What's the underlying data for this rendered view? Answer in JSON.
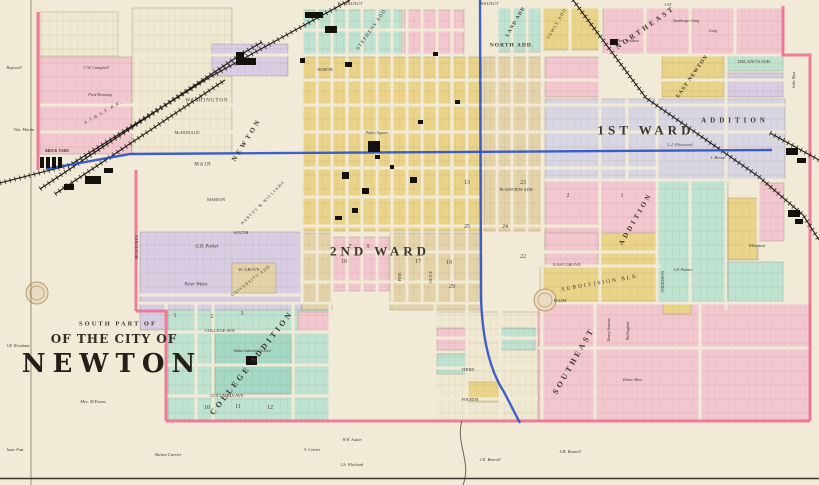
{
  "map": {
    "title": {
      "line1": "SOUTH PART OF",
      "line2": "OF THE CITY OF",
      "line3": "NEWTON"
    },
    "palette": {
      "paper": "#f1ead7",
      "cream": "#efe8d0",
      "pink": "#f3c7cf",
      "pinkline": "#ee6a8e",
      "yellow": "#e9d48a",
      "tan": "#e4d3a8",
      "teal": "#bfe2d1",
      "teal2": "#a5d8c5",
      "lav": "#d9cde3",
      "lavgrey": "#d9d6e4",
      "blue": "#2b50c8",
      "ink": "#14100c"
    },
    "regions": [
      [
        40,
        12,
        78,
        44,
        "cream"
      ],
      [
        40,
        57,
        92,
        97,
        "pink"
      ],
      [
        132,
        8,
        100,
        146,
        "cream"
      ],
      [
        212,
        44,
        76,
        32,
        "lav"
      ],
      [
        302,
        10,
        100,
        45,
        "teal"
      ],
      [
        404,
        10,
        60,
        45,
        "pink"
      ],
      [
        497,
        8,
        44,
        44,
        "teal"
      ],
      [
        543,
        8,
        58,
        42,
        "yellow"
      ],
      [
        603,
        8,
        180,
        46,
        "pink"
      ],
      [
        302,
        57,
        180,
        174,
        "yellow"
      ],
      [
        484,
        57,
        58,
        174,
        "tan"
      ],
      [
        545,
        57,
        55,
        40,
        "pink"
      ],
      [
        545,
        99,
        240,
        80,
        "lavgrey"
      ],
      [
        662,
        55,
        62,
        42,
        "yellow"
      ],
      [
        726,
        55,
        57,
        16,
        "teal"
      ],
      [
        726,
        73,
        57,
        24,
        "lav"
      ],
      [
        545,
        181,
        112,
        70,
        "pink"
      ],
      [
        658,
        181,
        70,
        122,
        "teal"
      ],
      [
        728,
        198,
        30,
        62,
        "yellow"
      ],
      [
        758,
        183,
        26,
        58,
        "pink"
      ],
      [
        728,
        262,
        55,
        48,
        "teal"
      ],
      [
        600,
        233,
        57,
        32,
        "yellow"
      ],
      [
        545,
        233,
        53,
        32,
        "pink"
      ],
      [
        540,
        267,
        118,
        34,
        "yellow"
      ],
      [
        538,
        303,
        272,
        117,
        "pink"
      ],
      [
        140,
        232,
        162,
        62,
        "lav"
      ],
      [
        140,
        296,
        162,
        34,
        "lav"
      ],
      [
        232,
        263,
        44,
        30,
        "tan"
      ],
      [
        333,
        237,
        56,
        54,
        "pink"
      ],
      [
        302,
        233,
        30,
        77,
        "tan"
      ],
      [
        390,
        233,
        92,
        77,
        "tan"
      ],
      [
        168,
        310,
        162,
        110,
        "teal"
      ],
      [
        215,
        332,
        76,
        62,
        "teal2"
      ],
      [
        298,
        312,
        32,
        20,
        "pink"
      ],
      [
        435,
        312,
        103,
        108,
        "cream"
      ],
      [
        437,
        328,
        30,
        22,
        "pink"
      ],
      [
        437,
        354,
        30,
        20,
        "teal"
      ],
      [
        467,
        382,
        32,
        20,
        "yellow"
      ],
      [
        500,
        328,
        35,
        22,
        "teal"
      ],
      [
        663,
        303,
        28,
        11,
        "yellow"
      ]
    ],
    "streets_h": [
      [
        7,
        300,
        785
      ],
      [
        30,
        302,
        464
      ],
      [
        55,
        137,
        785
      ],
      [
        80,
        302,
        785
      ],
      [
        105,
        40,
        785
      ],
      [
        132,
        40,
        785
      ],
      [
        168,
        137,
        657
      ],
      [
        180,
        545,
        785
      ],
      [
        197,
        137,
        482
      ],
      [
        226,
        137,
        600
      ],
      [
        252,
        302,
        657
      ],
      [
        266,
        545,
        660
      ],
      [
        282,
        302,
        482
      ],
      [
        295,
        140,
        302
      ],
      [
        303,
        137,
        810
      ],
      [
        332,
        166,
        330
      ],
      [
        338,
        430,
        538
      ],
      [
        348,
        538,
        810
      ],
      [
        365,
        166,
        330
      ],
      [
        368,
        430,
        538
      ],
      [
        396,
        166,
        330
      ],
      [
        399,
        430,
        538
      ]
    ],
    "streets_v": [
      [
        137,
        55,
        330
      ],
      [
        166,
        303,
        421
      ],
      [
        196,
        303,
        421
      ],
      [
        213,
        303,
        421
      ],
      [
        293,
        303,
        421
      ],
      [
        330,
        303,
        421
      ],
      [
        302,
        7,
        303
      ],
      [
        317,
        7,
        303
      ],
      [
        332,
        7,
        303
      ],
      [
        347,
        7,
        303
      ],
      [
        362,
        7,
        303
      ],
      [
        377,
        7,
        303
      ],
      [
        392,
        7,
        303
      ],
      [
        407,
        7,
        303
      ],
      [
        422,
        7,
        303
      ],
      [
        437,
        7,
        303
      ],
      [
        452,
        7,
        303
      ],
      [
        467,
        7,
        303
      ],
      [
        497,
        7,
        303
      ],
      [
        512,
        7,
        303
      ],
      [
        527,
        7,
        303
      ],
      [
        542,
        7,
        421
      ],
      [
        570,
        7,
        55
      ],
      [
        600,
        7,
        303
      ],
      [
        627,
        99,
        180
      ],
      [
        645,
        7,
        55
      ],
      [
        657,
        55,
        303
      ],
      [
        690,
        7,
        55
      ],
      [
        690,
        181,
        303
      ],
      [
        726,
        55,
        310
      ],
      [
        735,
        7,
        55
      ],
      [
        758,
        181,
        245
      ],
      [
        595,
        303,
        421
      ],
      [
        700,
        303,
        421
      ],
      [
        435,
        303,
        421
      ],
      [
        467,
        303,
        421
      ],
      [
        500,
        303,
        421
      ]
    ],
    "boundary": [
      "M38,12 L38,170",
      "M136,170 L136,311",
      "M136,311 L166,311 L166,421",
      "M166,421 L810,421",
      "M810,421 L810,55 L783,55 L783,6"
    ],
    "railroads": [
      "M0,183 L70,165 L210,77 L350,0",
      "M40,189 L240,55 L262,42",
      "M55,194 L225,80",
      "M573,0 L646,98 L758,176 L803,215 L819,240",
      "M770,133 L819,160"
    ],
    "water_blue": [
      "M46,169 L130,154 L772,150",
      "M480,0 L481,298 Q483,360 504,392 L520,423"
    ],
    "water_creek": [
      "M462,421 C455,442 472,462 463,485"
    ],
    "buildings": [
      [
        236,
        58,
        20,
        7
      ],
      [
        236,
        52,
        8,
        13
      ],
      [
        305,
        12,
        18,
        6
      ],
      [
        325,
        26,
        12,
        7
      ],
      [
        85,
        176,
        16,
        8
      ],
      [
        104,
        168,
        9,
        5
      ],
      [
        64,
        184,
        10,
        6
      ],
      [
        40,
        157,
        4,
        11
      ],
      [
        46,
        157,
        4,
        11
      ],
      [
        52,
        157,
        4,
        11
      ],
      [
        58,
        157,
        4,
        11
      ],
      [
        368,
        141,
        12,
        11
      ],
      [
        342,
        172,
        7,
        7
      ],
      [
        362,
        188,
        7,
        6
      ],
      [
        410,
        177,
        7,
        6
      ],
      [
        345,
        62,
        7,
        5
      ],
      [
        300,
        58,
        5,
        5
      ],
      [
        433,
        52,
        5,
        4
      ],
      [
        455,
        100,
        5,
        4
      ],
      [
        418,
        120,
        5,
        4
      ],
      [
        375,
        155,
        5,
        4
      ],
      [
        390,
        165,
        4,
        4
      ],
      [
        352,
        208,
        6,
        5
      ],
      [
        335,
        216,
        7,
        4
      ],
      [
        610,
        39,
        8,
        6
      ],
      [
        246,
        356,
        11,
        9
      ],
      [
        786,
        148,
        12,
        7
      ],
      [
        797,
        158,
        9,
        5
      ],
      [
        788,
        210,
        12,
        7
      ],
      [
        795,
        219,
        8,
        5
      ]
    ],
    "seals": [
      [
        37,
        293
      ],
      [
        545,
        300
      ]
    ],
    "labels": [
      {
        "t": "1ST WARD",
        "x": 646,
        "y": 130,
        "s": 13,
        "r": 0,
        "ls": 4,
        "b": 1
      },
      {
        "t": "2ND WARD",
        "x": 380,
        "y": 251,
        "s": 13,
        "r": 0,
        "ls": 4,
        "b": 1
      },
      {
        "t": "NORTHEAST",
        "x": 646,
        "y": 28,
        "s": 7,
        "r": -35,
        "ls": 3,
        "b": 1
      },
      {
        "t": "NORTH ADD.",
        "x": 512,
        "y": 46,
        "s": 5.5,
        "r": 0,
        "ls": 1,
        "b": 1
      },
      {
        "t": "LAND ADD",
        "x": 516,
        "y": 22,
        "s": 5,
        "r": -60,
        "ls": 1,
        "b": 1
      },
      {
        "t": "TOWLE ADD",
        "x": 557,
        "y": 24,
        "s": 4.5,
        "r": -60,
        "ls": 1
      },
      {
        "t": "EAST NEWTON",
        "x": 693,
        "y": 77,
        "s": 5.5,
        "r": -55,
        "ls": 1,
        "b": 1
      },
      {
        "t": "DELANO'S SUB",
        "x": 754,
        "y": 62,
        "s": 4.5,
        "r": 0,
        "ls": 0
      },
      {
        "t": "STEPHENS ADD",
        "x": 372,
        "y": 30,
        "s": 5,
        "r": -55,
        "ls": 1
      },
      {
        "t": "NEWTON",
        "x": 247,
        "y": 140,
        "s": 7,
        "r": -58,
        "ls": 3,
        "b": 1
      },
      {
        "t": "ADDITION",
        "x": 636,
        "y": 219,
        "s": 7,
        "r": -60,
        "ls": 3,
        "b": 1
      },
      {
        "t": "ADDITION",
        "x": 735,
        "y": 121,
        "s": 7,
        "r": 0,
        "ls": 4,
        "b": 1
      },
      {
        "t": "PLAINVIEW ADD",
        "x": 516,
        "y": 190,
        "s": 4.2,
        "r": 0,
        "ls": 0
      },
      {
        "t": "COLLEGE ADDITION",
        "x": 252,
        "y": 363,
        "s": 8,
        "r": -52,
        "ls": 3,
        "b": 1
      },
      {
        "t": "SOUTHEAST",
        "x": 574,
        "y": 361,
        "s": 8,
        "r": -60,
        "ls": 3,
        "b": 1
      },
      {
        "t": "SUBDIVISION BLK",
        "x": 600,
        "y": 284,
        "s": 5.5,
        "r": -10,
        "ls": 2
      },
      {
        "t": "HARVEY & WILLIAMS",
        "x": 263,
        "y": 203,
        "s": 4.2,
        "r": -45,
        "ls": 1
      },
      {
        "t": "UNIVERSITY ADD",
        "x": 251,
        "y": 281,
        "s": 4.2,
        "r": -38,
        "ls": 1
      },
      {
        "t": "A.T.& S.F. R.R.",
        "x": 103,
        "y": 113,
        "s": 4.5,
        "r": -30,
        "ls": 1,
        "i": 1
      },
      {
        "t": "W. WALNUT",
        "x": 350,
        "y": 4,
        "s": 4.5,
        "r": 0
      },
      {
        "t": "WALNUT",
        "x": 489,
        "y": 4,
        "s": 4.5,
        "r": 0
      },
      {
        "t": "NORTH",
        "x": 325,
        "y": 70,
        "s": 4.5,
        "r": 0
      },
      {
        "t": "WASHINGTON",
        "x": 207,
        "y": 101,
        "s": 5,
        "r": 0,
        "ls": 1
      },
      {
        "t": "McDONALD",
        "x": 187,
        "y": 133,
        "s": 4.5,
        "r": 0
      },
      {
        "t": "MAIN",
        "x": 203,
        "y": 165,
        "s": 5,
        "r": 0,
        "ls": 1
      },
      {
        "t": "MARION",
        "x": 216,
        "y": 200,
        "s": 4.5,
        "r": 0
      },
      {
        "t": "SOUTH",
        "x": 241,
        "y": 233,
        "s": 4.5,
        "r": 0
      },
      {
        "t": "W. GROVE",
        "x": 249,
        "y": 270,
        "s": 4.5,
        "r": 0
      },
      {
        "t": "EAST GROVE",
        "x": 567,
        "y": 265,
        "s": 4.5,
        "r": 0
      },
      {
        "t": "PLUM",
        "x": 560,
        "y": 301,
        "s": 4.5,
        "r": 0
      },
      {
        "t": "COLLEGE AVE",
        "x": 220,
        "y": 331,
        "s": 4.5,
        "r": 0
      },
      {
        "t": "COLUMBIA AVE",
        "x": 227,
        "y": 396,
        "s": 4.5,
        "r": 0
      },
      {
        "t": "MONTEREY",
        "x": 137,
        "y": 247,
        "s": 4.5,
        "r": -90
      },
      {
        "t": "PINE",
        "x": 400,
        "y": 277,
        "s": 4,
        "r": -90
      },
      {
        "t": "OLIVE",
        "x": 431,
        "y": 277,
        "s": 4,
        "r": -90
      },
      {
        "t": "ANDERSON",
        "x": 663,
        "y": 282,
        "s": 4,
        "r": -90
      },
      {
        "t": "THIRD",
        "x": 468,
        "y": 370,
        "s": 4.2,
        "r": 0
      },
      {
        "t": "FOURTH",
        "x": 470,
        "y": 400,
        "s": 4.2,
        "r": 0
      },
      {
        "t": "1 ST",
        "x": 668,
        "y": 5,
        "s": 4.2,
        "r": 0
      },
      {
        "t": "C.W. Campbell",
        "x": 96,
        "y": 68,
        "s": 4.2,
        "r": 0,
        "i": 1
      },
      {
        "t": "Fred Henning",
        "x": 100,
        "y": 95,
        "s": 4.2,
        "r": 0,
        "i": 1
      },
      {
        "t": "Wm. Martin",
        "x": 24,
        "y": 130,
        "s": 4.2,
        "r": 0,
        "i": 1
      },
      {
        "t": "Hopewell",
        "x": 14,
        "y": 68,
        "s": 4,
        "r": 0,
        "i": 1
      },
      {
        "t": "BRICK YARD",
        "x": 57,
        "y": 152,
        "s": 3.8,
        "r": 0,
        "b": 1
      },
      {
        "t": "Public Square",
        "x": 377,
        "y": 133,
        "s": 4,
        "r": 0,
        "i": 1
      },
      {
        "t": "L.J. Fleetwood",
        "x": 680,
        "y": 145,
        "s": 4.2,
        "r": 0,
        "i": 1
      },
      {
        "t": "J. Brown",
        "x": 718,
        "y": 158,
        "s": 4.2,
        "r": 0,
        "i": 1
      },
      {
        "t": "G.B. Parker",
        "x": 207,
        "y": 248,
        "s": 4.8,
        "r": 0,
        "i": 1
      },
      {
        "t": "Peter Wiens",
        "x": 196,
        "y": 286,
        "s": 4.8,
        "r": 0,
        "i": 1
      },
      {
        "t": "Mrs. M Evans",
        "x": 93,
        "y": 402,
        "s": 4.5,
        "r": 0,
        "i": 1
      },
      {
        "t": "Abram Carrier",
        "x": 168,
        "y": 455,
        "s": 4.5,
        "r": 0,
        "i": 1
      },
      {
        "t": "A. Carrier",
        "x": 312,
        "y": 450,
        "s": 4,
        "r": 0,
        "i": 1
      },
      {
        "t": "Isaac Fast",
        "x": 15,
        "y": 450,
        "s": 4,
        "r": 0,
        "i": 1
      },
      {
        "t": "J.E. Burrell",
        "x": 490,
        "y": 460,
        "s": 4.5,
        "r": 0,
        "i": 1
      },
      {
        "t": "J.H. Russell",
        "x": 570,
        "y": 452,
        "s": 4.5,
        "r": 0,
        "i": 1
      },
      {
        "t": "W.H. Austin",
        "x": 352,
        "y": 440,
        "s": 4,
        "r": 0,
        "i": 1
      },
      {
        "t": "Ch. Whichard",
        "x": 352,
        "y": 465,
        "s": 4,
        "r": 0,
        "i": 1
      },
      {
        "t": "Steinberger Long",
        "x": 686,
        "y": 22,
        "s": 3.8,
        "r": 0,
        "i": 1
      },
      {
        "t": "Long",
        "x": 713,
        "y": 32,
        "s": 3.8,
        "r": 0,
        "i": 1
      },
      {
        "t": "Paul Woodson",
        "x": 628,
        "y": 42,
        "s": 3.8,
        "r": 0,
        "i": 1
      },
      {
        "t": "Henry Stearns",
        "x": 609,
        "y": 330,
        "s": 4,
        "r": -90,
        "i": 1
      },
      {
        "t": "Wallingford",
        "x": 628,
        "y": 331,
        "s": 4,
        "r": -90,
        "i": 1
      },
      {
        "t": "Elmer Bros.",
        "x": 633,
        "y": 380,
        "s": 4.2,
        "r": 0,
        "i": 1
      },
      {
        "t": "A.F. Palmer",
        "x": 683,
        "y": 270,
        "s": 4,
        "r": 0,
        "i": 1
      },
      {
        "t": "Whitehead",
        "x": 757,
        "y": 247,
        "s": 3.8,
        "r": 0,
        "i": 1
      },
      {
        "t": "J.R. Woodman",
        "x": 18,
        "y": 346,
        "s": 4,
        "r": 0,
        "i": 1
      },
      {
        "t": "John Wyss",
        "x": 794,
        "y": 80,
        "s": 4,
        "r": -90,
        "i": 1
      },
      {
        "t": "Indian Industrial School",
        "x": 252,
        "y": 352,
        "s": 3.8,
        "r": 0,
        "i": 1
      }
    ],
    "numbers": [
      {
        "t": "13",
        "x": 467,
        "y": 183
      },
      {
        "t": "23",
        "x": 523,
        "y": 183
      },
      {
        "t": "25",
        "x": 467,
        "y": 227
      },
      {
        "t": "24",
        "x": 505,
        "y": 227
      },
      {
        "t": "22",
        "x": 523,
        "y": 257
      },
      {
        "t": "17",
        "x": 418,
        "y": 262
      },
      {
        "t": "19",
        "x": 449,
        "y": 263
      },
      {
        "t": "29",
        "x": 452,
        "y": 287
      },
      {
        "t": "2",
        "x": 568,
        "y": 196
      },
      {
        "t": "1",
        "x": 622,
        "y": 196
      },
      {
        "t": "7",
        "x": 350,
        "y": 247
      },
      {
        "t": "9",
        "x": 368,
        "y": 247
      },
      {
        "t": "10",
        "x": 344,
        "y": 262
      },
      {
        "t": "1",
        "x": 175,
        "y": 316
      },
      {
        "t": "2",
        "x": 212,
        "y": 317
      },
      {
        "t": "3",
        "x": 242,
        "y": 314
      },
      {
        "t": "10",
        "x": 207,
        "y": 408
      },
      {
        "t": "11",
        "x": 238,
        "y": 407
      },
      {
        "t": "12",
        "x": 270,
        "y": 408
      }
    ]
  }
}
